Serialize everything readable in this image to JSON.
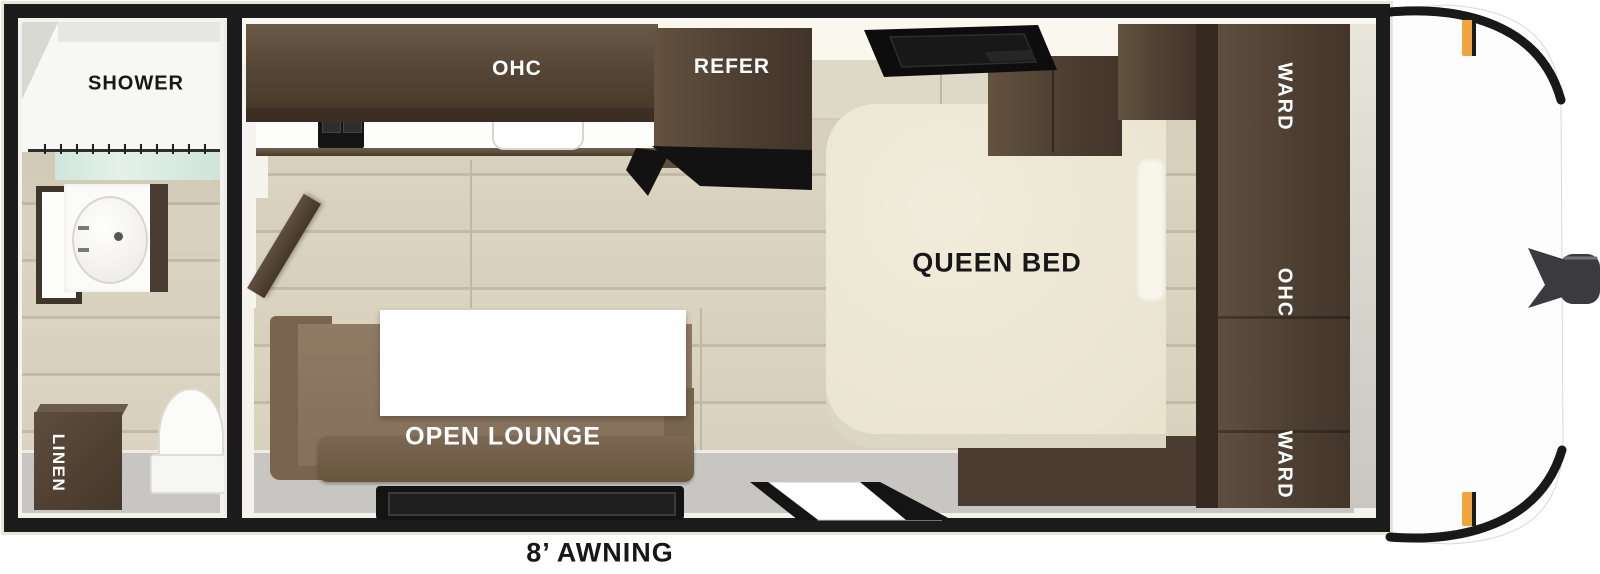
{
  "rooms": {
    "bathroom": {
      "shower": "SHOWER",
      "linen": "LINEN"
    },
    "kitchen": {
      "overhead_cabinet": "OHC",
      "refrigerator": "REFER"
    },
    "bedroom": {
      "bed": "QUEEN BED",
      "wardrobe_top": "WARD",
      "overhead_cabinet": "OHC",
      "wardrobe_bottom": "WARD"
    },
    "lounge": {
      "label": "OPEN LOUNGE"
    },
    "exterior": {
      "awning": "8’ AWNING"
    }
  },
  "colors": {
    "frame_black": "#1c1c1c",
    "cabinet_brown": "#54453a",
    "sofa_brown": "#86705b",
    "bed_cream": "#ece6d2",
    "floor_beige": "#d6d0bc",
    "entry_gray": "#c7c6c2",
    "curtain_teal": "#d4e9e0",
    "marker_amber": "#f0a43c"
  }
}
